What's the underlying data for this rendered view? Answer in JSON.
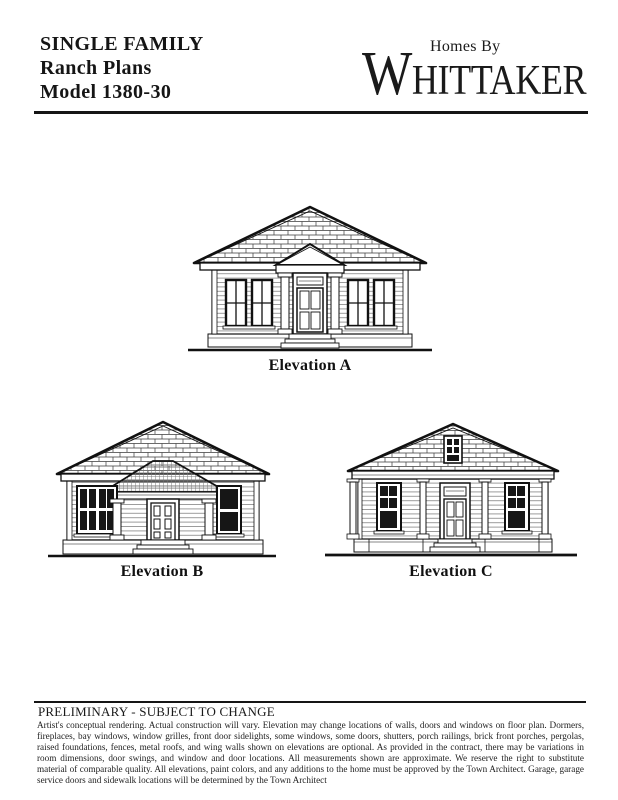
{
  "header": {
    "title_lines": [
      "SINGLE FAMILY",
      "Ranch Plans",
      "Model 1380-30"
    ],
    "brand_top": "Homes By",
    "brand_initial": "W",
    "brand_rest": "HITTAKER"
  },
  "elevations": {
    "a_label": "Elevation A",
    "b_label": "Elevation B",
    "c_label": "Elevation C"
  },
  "footer": {
    "status": "PRELIMINARY - SUBJECT TO CHANGE",
    "disclaimer": "Artist's conceptual rendering.  Actual construction will vary.  Elevation may change locations of walls, doors and windows on floor plan.  Dormers, fireplaces, bay windows, window grilles, front door sidelights, some windows, some doors, shutters, porch railings, brick front porches, pergolas, raised foundations, fences, metal roofs, and wing walls shown on elevations are optional.  As provided in the contract, there may be variations in room dimensions, door swings, and window and door locations.  All measurements shown are approximate.  We reserve the right to substitute material of comparable quality.  All elevations, paint colors, and any additions to the home must be approved by the Town Architect.  Garage, garage service doors and sidewalk locations will be determined by the Town Architect"
  },
  "colors": {
    "ink": "#151515",
    "paper": "#ffffff"
  }
}
